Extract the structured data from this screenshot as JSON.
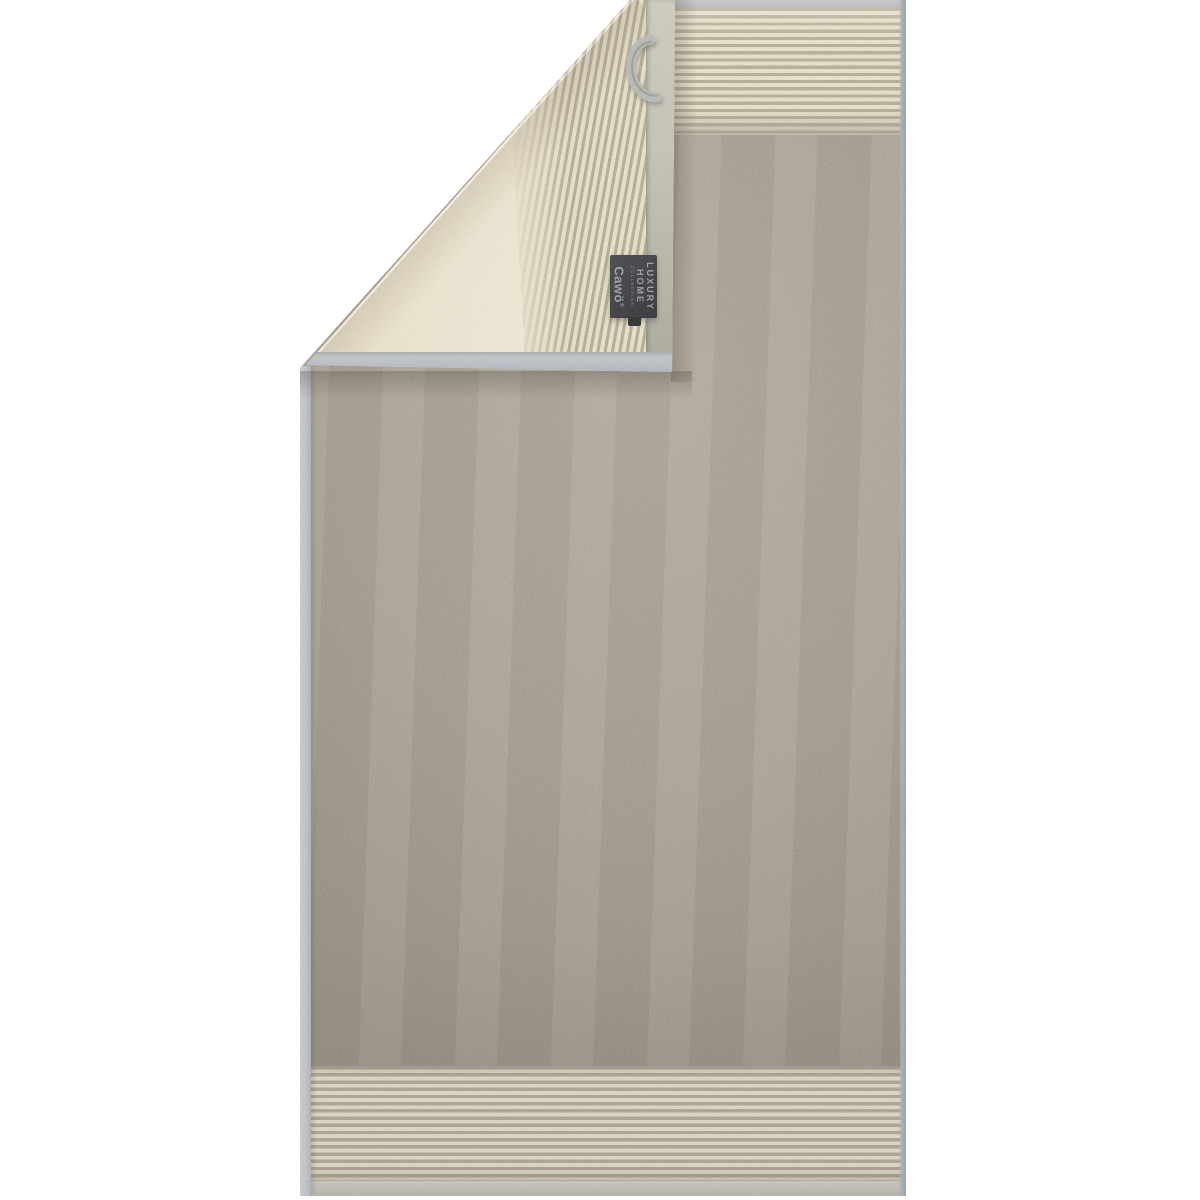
{
  "background_color": "#ffffff",
  "label": {
    "luxury": "LUXURY",
    "home": "HOME",
    "collection": "COLLECTION",
    "brand": "Cawö",
    "registered": "®"
  },
  "colors": {
    "towel-grey": "#a49d91",
    "towel-grey-light": "#aea79a",
    "towel-grey-dark": "#958e83",
    "reverse-cream": "#e9e0ca",
    "reverse-cream-light": "#f1e9d6",
    "stripe-cream": "#e7dec5",
    "stripe-grey": "#b3aa97",
    "stripe-cream-dim": "#dcd3be",
    "stripe-grey-dim": "#a89f8f",
    "hem-top": "#c6c8ca",
    "hem-left": "#bcc1c7",
    "hem-right": "#a6acb4",
    "hem-bottom": "#c5c2b9",
    "flap-hem-side": "#c2c1b2",
    "flap-hem-bottom": "#b8bdc3",
    "label-bg": "#3a3c3f",
    "label-text": "#9a9da4",
    "loop": "#b4b7b2"
  }
}
